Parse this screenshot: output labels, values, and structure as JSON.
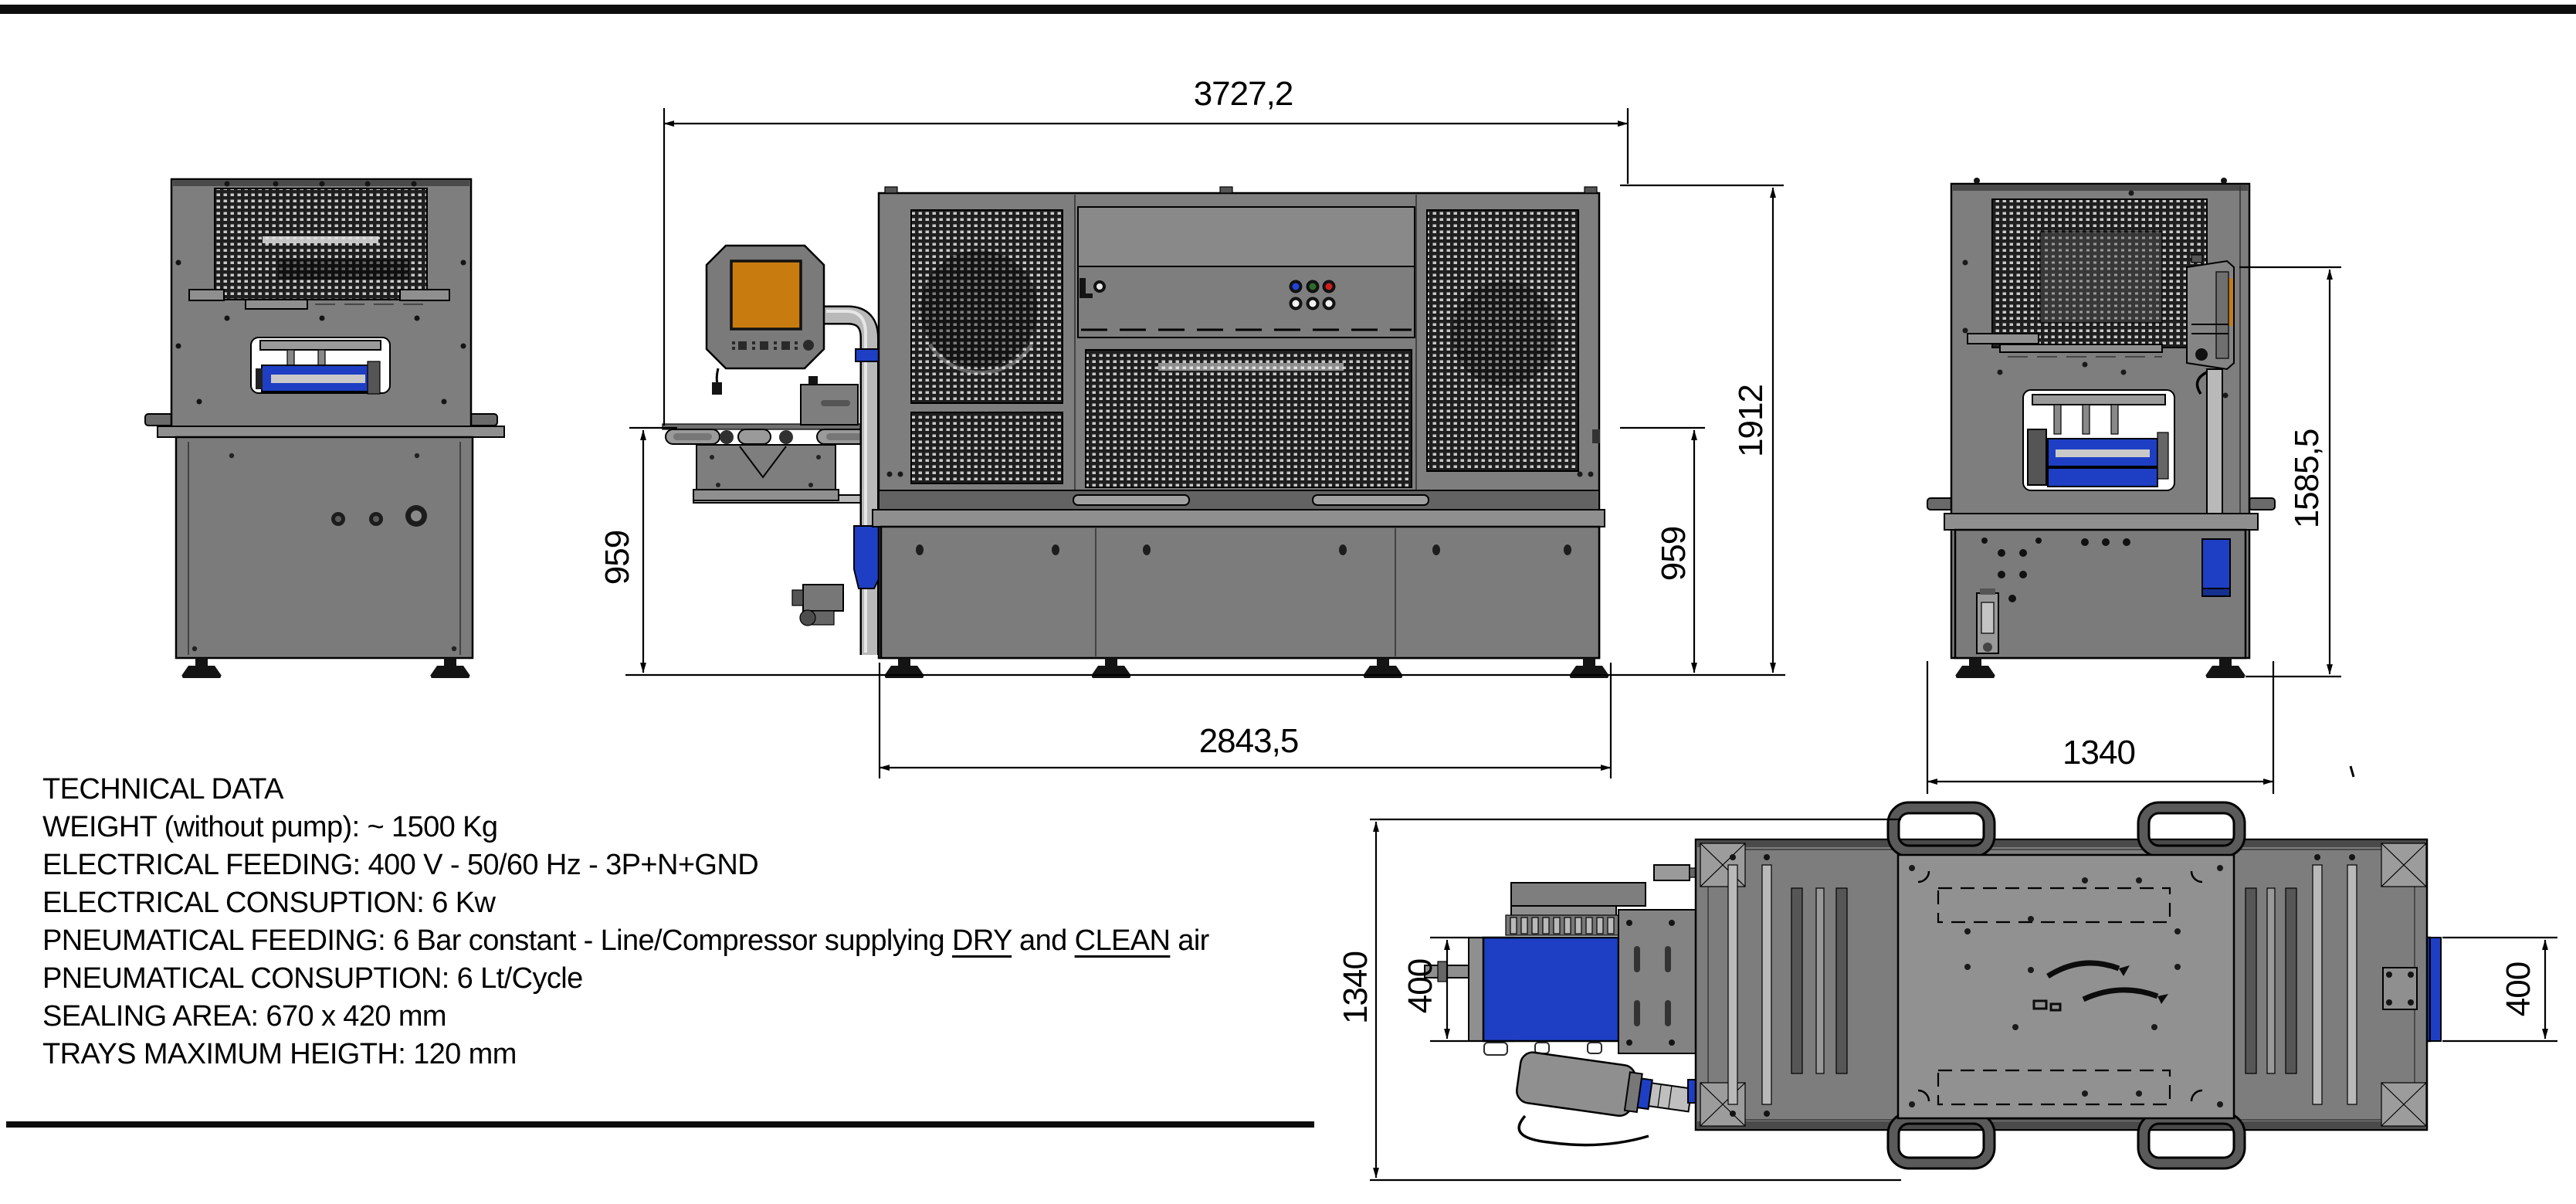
{
  "document": {
    "type": "machine technical drawing sheet",
    "background": "#ffffff",
    "border_color": "#0d0d0d"
  },
  "technical_data": {
    "title": "TECHNICAL DATA",
    "weight": "WEIGHT (without pump): ~ 1500 Kg",
    "electrical_feeding": "ELECTRICAL FEEDING: 400 V - 50/60 Hz - 3P+N+GND",
    "electrical_consuption": "ELECTRICAL CONSUPTION: 6 Kw",
    "pneumatical_feeding": {
      "prefix": "PNEUMATICAL FEEDING: 6 Bar constant - Line/Compressor supplying ",
      "dry": "DRY",
      "and": " and ",
      "clean": "CLEAN",
      "suffix": " air"
    },
    "pneumatical_consuption": "PNEUMATICAL CONSUPTION: 6 Lt/Cycle",
    "sealing_area": "SEALING AREA: 670 x 420 mm",
    "trays_max_height": "TRAYS MAXIMUM HEIGTH: 120 mm"
  },
  "dimensions": {
    "front_view": {
      "overall_width": "3727,2",
      "conveyor_height_left": "959",
      "overall_height": "1912",
      "conveyor_height_right": "959",
      "base_width": "2843,5"
    },
    "side_view": {
      "lid_height": "1585,5",
      "width": "1340"
    },
    "plan_view": {
      "depth": "1340",
      "infeed_belt_width": "400",
      "outfeed_belt_width": "400"
    }
  },
  "colors": {
    "machine_grey": "#7e7e7e",
    "perforated_panel": "#1f1f1f",
    "accent_blue": "#1e3fc4",
    "accent_blue_dark": "#15308f",
    "screen_orange": "#c87c10",
    "pilot_blue": "#2244dd",
    "pilot_green": "#2d6b2d",
    "pilot_red": "#cf1f1f",
    "line_black": "#000000"
  }
}
